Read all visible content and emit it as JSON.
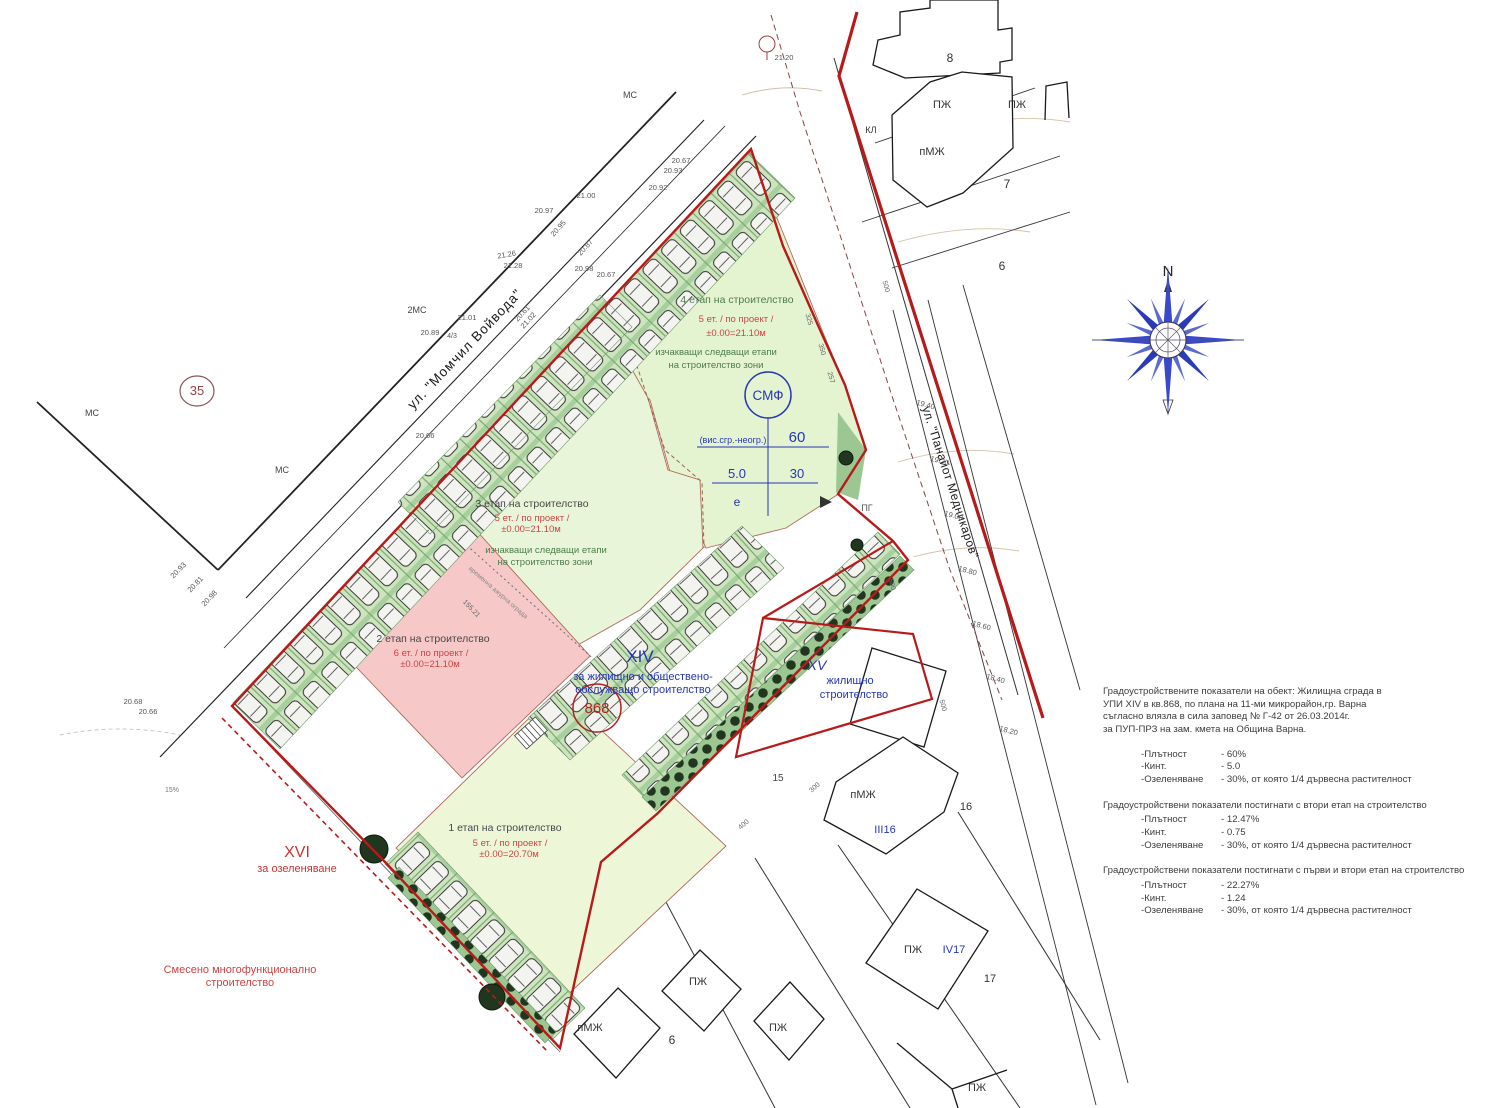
{
  "colors": {
    "regulation_red": "#b81a1a",
    "dashed_old_line": "#8b4444",
    "zone_green": "#e4f3d0",
    "zone3_green": "#e9f5d8",
    "zone1_green": "#eef6d8",
    "stage2_pink": "#f6c8c8",
    "parking_green": "#cde5bd",
    "tree_dark": "#20361f",
    "wedge_green": "#9cc793",
    "plan_blue": "#2636b8",
    "stage_red_text": "#cc4444",
    "stage_green_text": "#4c7d4c",
    "label_red": "#cc3333",
    "circle_red": "#b22222",
    "building_line": "#1a1a1a"
  },
  "compass": {
    "north_label": "N"
  },
  "stats": {
    "intro_lines": [
      "Градоустройствените показатели на обект: Жилищна сграда в",
      "УПИ XIV в кв.868, по плана на 11-ми микрорайон,гр. Варна",
      "съгласно влязла в сила заповед № Г-42 от 26.03.2014г.",
      "за ПУП-ПРЗ на зам. кмета на Община Варна."
    ],
    "groups": [
      {
        "title": "",
        "rows": [
          {
            "label": "-Плътност",
            "value": "-  60%"
          },
          {
            "label": "-Кинт.",
            "value": "-  5.0"
          },
          {
            "label": "-Озеленяване",
            "value": "-  30%, от която 1/4 дървесна растителност"
          }
        ]
      },
      {
        "title": "Градоустройствени показатели постигнати с втори етап на строителство",
        "rows": [
          {
            "label": "-Плътност",
            "value": "- 12.47%"
          },
          {
            "label": "-Кинт.",
            "value": "- 0.75"
          },
          {
            "label": "-Озеленяване",
            "value": "- 30%, от която 1/4 дървесна растителност"
          }
        ]
      },
      {
        "title": "Градоустройствени показатели постигнати с първи и втори етап на строителство",
        "rows": [
          {
            "label": "-Плътност",
            "value": "- 22.27%"
          },
          {
            "label": "-Кинт.",
            "value": "- 1.24"
          },
          {
            "label": "-Озеленяване",
            "value": "- 30%, от която 1/4 дървесна растителност"
          }
        ]
      }
    ]
  },
  "plan": {
    "default_label_color": "#555555",
    "labels": [
      {
        "id": "street-momchil-voyvoda-label",
        "text": "ул. \"Момчил Войвода\"",
        "x": 468,
        "y": 352,
        "size": 13.5,
        "color": "#1a1a1a",
        "rotate": -46.5,
        "spacing": 1
      },
      {
        "id": "street-panayot-mednikarov-label",
        "text": "ул. \"Панайот Медникаров\"",
        "x": 922,
        "y": 408,
        "size": 12,
        "color": "#1a1a1a",
        "rotate": 72,
        "anchor": "start",
        "spacing": 0.5
      },
      {
        "id": "stage4-title",
        "text": "4 етап на строителство",
        "x": 737,
        "y": 303,
        "size": 10.5,
        "color": "#4c7d4c"
      },
      {
        "id": "stage4-floors",
        "text": "5 ет. / по проект /",
        "x": 736,
        "y": 322,
        "size": 9.5,
        "color": "#cc4444"
      },
      {
        "id": "stage4-level",
        "text": "±0.00=21.10м",
        "x": 736,
        "y": 336,
        "size": 9.5,
        "color": "#cc4444"
      },
      {
        "id": "stage4-note-1",
        "text": "изчакващи следващи етапи",
        "x": 716,
        "y": 355,
        "size": 9.5,
        "color": "#4c7d4c"
      },
      {
        "id": "stage4-note-2",
        "text": "на строителство зони",
        "x": 716,
        "y": 368,
        "size": 9.5,
        "color": "#4c7d4c"
      },
      {
        "id": "stage3-title",
        "text": "3 етап на строителство",
        "x": 532,
        "y": 507,
        "size": 10.5,
        "color": "#474747"
      },
      {
        "id": "stage3-floors",
        "text": "5 ет. / по проект /",
        "x": 532,
        "y": 521,
        "size": 9.5,
        "color": "#cc4444"
      },
      {
        "id": "stage3-level",
        "text": "±0.00=21.10м",
        "x": 531,
        "y": 532,
        "size": 9.5,
        "color": "#cc4444"
      },
      {
        "id": "stage3-note-1",
        "text": "изчакващи следващи етапи",
        "x": 546,
        "y": 553,
        "size": 9.5,
        "color": "#4c7d4c"
      },
      {
        "id": "stage3-note-2",
        "text": "на строителство зони",
        "x": 545,
        "y": 565,
        "size": 9.5,
        "color": "#4c7d4c"
      },
      {
        "id": "stage2-title",
        "text": "2 етап на строителство",
        "x": 433,
        "y": 642,
        "size": 10.5,
        "color": "#474747"
      },
      {
        "id": "stage2-floors",
        "text": "6 ет. / по проект /",
        "x": 431,
        "y": 656,
        "size": 9.5,
        "color": "#cc4444"
      },
      {
        "id": "stage2-level",
        "text": "±0.00=21.10м",
        "x": 430,
        "y": 667,
        "size": 9.5,
        "color": "#cc4444"
      },
      {
        "id": "stage1-title",
        "text": "1 етап на строителство",
        "x": 505,
        "y": 831,
        "size": 10.5,
        "color": "#474747"
      },
      {
        "id": "stage1-floors",
        "text": "5 ет. / по проект /",
        "x": 510,
        "y": 846,
        "size": 9.5,
        "color": "#cc4444"
      },
      {
        "id": "stage1-level",
        "text": "±0.00=20.70м",
        "x": 509,
        "y": 857,
        "size": 9.5,
        "color": "#cc4444"
      },
      {
        "id": "parcel-xiv-label",
        "text": "XIV",
        "x": 640,
        "y": 662,
        "size": 17,
        "color": "#2636b8"
      },
      {
        "id": "parcel-xiv-use-1",
        "text": "за жилищно и обществено-",
        "x": 643,
        "y": 680,
        "size": 11,
        "color": "#2636b8"
      },
      {
        "id": "parcel-xiv-use-2",
        "text": "обслужващо строителство",
        "x": 643,
        "y": 693,
        "size": 11,
        "color": "#2636b8"
      },
      {
        "id": "quarter-868-label",
        "text": "868",
        "x": 597,
        "y": 713,
        "size": 15,
        "color": "#b22222"
      },
      {
        "id": "parcel-xv-label",
        "text": "XV",
        "x": 817,
        "y": 670,
        "size": 14,
        "color": "#2636b8",
        "italic": true
      },
      {
        "id": "parcel-xv-use-1",
        "text": "жилищно",
        "x": 850,
        "y": 684,
        "size": 11,
        "color": "#2636b8"
      },
      {
        "id": "parcel-xv-use-2",
        "text": "строителство",
        "x": 854,
        "y": 698,
        "size": 11,
        "color": "#2636b8"
      },
      {
        "id": "parcel-xvi-label",
        "text": "XVI",
        "x": 297,
        "y": 857,
        "size": 16,
        "color": "#cc3333"
      },
      {
        "id": "parcel-xvi-use",
        "text": "за озеленяване",
        "x": 297,
        "y": 872,
        "size": 11,
        "color": "#cc3333"
      },
      {
        "id": "mixed-use-note-1",
        "text": "Смесено многофункционално",
        "x": 240,
        "y": 973,
        "size": 11,
        "color": "#cc4444"
      },
      {
        "id": "mixed-use-note-2",
        "text": "строителство",
        "x": 240,
        "y": 986,
        "size": 11,
        "color": "#cc4444"
      },
      {
        "id": "smf-circle-label",
        "text": "СМФ",
        "x": 768,
        "y": 400,
        "size": 13.5,
        "color": "#2636b8"
      },
      {
        "id": "smf-height-note",
        "text": "(вис.сгр.-неогр.)",
        "x": 733,
        "y": 443,
        "size": 9,
        "color": "#2636b8"
      },
      {
        "id": "smf-value-60",
        "text": "60",
        "x": 797,
        "y": 442,
        "size": 15,
        "color": "#2636b8"
      },
      {
        "id": "smf-value-5-0",
        "text": "5.0",
        "x": 737,
        "y": 478,
        "size": 13,
        "color": "#2636b8"
      },
      {
        "id": "smf-value-30",
        "text": "30",
        "x": 797,
        "y": 478,
        "size": 13,
        "color": "#2636b8"
      },
      {
        "id": "smf-value-e",
        "text": "е",
        "x": 737,
        "y": 506,
        "size": 12,
        "color": "#2636b8"
      },
      {
        "id": "parcel-35-label",
        "text": "35",
        "x": 197,
        "y": 395,
        "size": 13,
        "color": "#994444"
      },
      {
        "id": "compass-n-label",
        "text": "N",
        "x": 1168,
        "y": 276,
        "size": 15,
        "color": "#222222"
      },
      {
        "text": "8",
        "x": 950,
        "y": 62,
        "size": 12,
        "color": "#333"
      },
      {
        "text": "ПЖ",
        "x": 942,
        "y": 108,
        "size": 11,
        "color": "#333"
      },
      {
        "text": "ПЖ",
        "x": 1017,
        "y": 108,
        "size": 11,
        "color": "#333"
      },
      {
        "text": "пМЖ",
        "x": 932,
        "y": 155,
        "size": 11,
        "color": "#333"
      },
      {
        "text": "КЛ",
        "x": 871,
        "y": 133,
        "size": 9,
        "color": "#333"
      },
      {
        "text": "7",
        "x": 1007,
        "y": 188,
        "size": 12,
        "color": "#333"
      },
      {
        "text": "6",
        "x": 1002,
        "y": 270,
        "size": 12,
        "color": "#333"
      },
      {
        "text": "15",
        "x": 778,
        "y": 781,
        "size": 10,
        "color": "#444"
      },
      {
        "text": "пМЖ",
        "x": 863,
        "y": 798,
        "size": 11,
        "color": "#333"
      },
      {
        "text": "16",
        "x": 966,
        "y": 810,
        "size": 11,
        "color": "#333"
      },
      {
        "text": "III16",
        "x": 885,
        "y": 833,
        "size": 11,
        "color": "#2636b8"
      },
      {
        "text": "ПЖ",
        "x": 913,
        "y": 953,
        "size": 11,
        "color": "#333"
      },
      {
        "text": "IV17",
        "x": 954,
        "y": 953,
        "size": 11,
        "color": "#2636b8"
      },
      {
        "text": "17",
        "x": 990,
        "y": 982,
        "size": 11,
        "color": "#333"
      },
      {
        "text": "пМЖ",
        "x": 590,
        "y": 1031,
        "size": 11,
        "color": "#333"
      },
      {
        "text": "6",
        "x": 672,
        "y": 1044,
        "size": 12,
        "color": "#333"
      },
      {
        "text": "ПЖ",
        "x": 698,
        "y": 985,
        "size": 11,
        "color": "#333"
      },
      {
        "text": "ПЖ",
        "x": 778,
        "y": 1031,
        "size": 11,
        "color": "#333"
      },
      {
        "text": "ПЖ",
        "x": 977,
        "y": 1091,
        "size": 11,
        "color": "#333"
      },
      {
        "text": "ПГ",
        "x": 867,
        "y": 511,
        "size": 9,
        "color": "#555"
      },
      {
        "text": "МС",
        "x": 92,
        "y": 416,
        "size": 9,
        "color": "#444"
      },
      {
        "text": "МС",
        "x": 282,
        "y": 473,
        "size": 9,
        "color": "#444"
      },
      {
        "text": "МС",
        "x": 630,
        "y": 98,
        "size": 9,
        "color": "#444"
      },
      {
        "text": "2МС",
        "x": 417,
        "y": 313,
        "size": 9,
        "color": "#444"
      },
      {
        "text": "4/3",
        "x": 452,
        "y": 338,
        "size": 7,
        "color": "#555"
      },
      {
        "text": "21.20",
        "x": 784,
        "y": 60,
        "size": 7.5
      },
      {
        "text": "20.67",
        "x": 681,
        "y": 163,
        "size": 7.5
      },
      {
        "text": "20.93",
        "x": 673,
        "y": 173,
        "size": 7.5
      },
      {
        "text": "20.92",
        "x": 658,
        "y": 190,
        "size": 7.5
      },
      {
        "text": "21.00",
        "x": 586,
        "y": 198,
        "size": 7.5
      },
      {
        "text": "20.97",
        "x": 544,
        "y": 213,
        "size": 7.5
      },
      {
        "text": "20.95",
        "x": 560,
        "y": 230,
        "size": 7.5,
        "rotate": -48
      },
      {
        "text": "21.26",
        "x": 507,
        "y": 257,
        "size": 7.5,
        "rotate": -10
      },
      {
        "text": "21.28",
        "x": 513,
        "y": 268,
        "size": 7.5
      },
      {
        "text": "20.87",
        "x": 587,
        "y": 249,
        "size": 7.5,
        "rotate": -48
      },
      {
        "text": "20.98",
        "x": 584,
        "y": 271,
        "size": 7.5
      },
      {
        "text": "20.67",
        "x": 606,
        "y": 277,
        "size": 7.5
      },
      {
        "text": "20.89",
        "x": 430,
        "y": 335,
        "size": 7.5
      },
      {
        "text": "21.01",
        "x": 467,
        "y": 320,
        "size": 7.5
      },
      {
        "text": "20.61",
        "x": 524,
        "y": 315,
        "size": 7.5,
        "rotate": -48
      },
      {
        "text": "21.02",
        "x": 530,
        "y": 322,
        "size": 7.5,
        "rotate": -48
      },
      {
        "text": "20.66",
        "x": 425,
        "y": 438,
        "size": 7.5
      },
      {
        "text": "20.93",
        "x": 180,
        "y": 572,
        "size": 7.5,
        "rotate": -46
      },
      {
        "text": "20.81",
        "x": 197,
        "y": 586,
        "size": 7.5,
        "rotate": -46
      },
      {
        "text": "20.98",
        "x": 211,
        "y": 600,
        "size": 7.5,
        "rotate": -46
      },
      {
        "text": "20.68",
        "x": 133,
        "y": 704,
        "size": 7.5
      },
      {
        "text": "20.66",
        "x": 148,
        "y": 714,
        "size": 7.5
      },
      {
        "text": "19.40",
        "x": 925,
        "y": 407,
        "size": 7.5,
        "rotate": 15
      },
      {
        "text": "19.20",
        "x": 939,
        "y": 463,
        "size": 7.5,
        "rotate": 15
      },
      {
        "text": "19.00",
        "x": 953,
        "y": 518,
        "size": 7.5,
        "rotate": 15
      },
      {
        "text": "18.80",
        "x": 967,
        "y": 573,
        "size": 7.5,
        "rotate": 15
      },
      {
        "text": "18.60",
        "x": 981,
        "y": 628,
        "size": 7.5,
        "rotate": 15
      },
      {
        "text": "18.40",
        "x": 995,
        "y": 681,
        "size": 7.5,
        "rotate": 15
      },
      {
        "text": "18.20",
        "x": 1008,
        "y": 733,
        "size": 7.5,
        "rotate": 15
      },
      {
        "text": "325",
        "x": 807,
        "y": 320,
        "size": 7,
        "color": "#666",
        "rotate": 74
      },
      {
        "text": "350",
        "x": 820,
        "y": 350,
        "size": 7,
        "color": "#666",
        "rotate": 74
      },
      {
        "text": "257",
        "x": 829,
        "y": 378,
        "size": 7,
        "color": "#666",
        "rotate": 74
      },
      {
        "text": "500",
        "x": 884,
        "y": 287,
        "size": 7,
        "color": "#666",
        "rotate": 74
      },
      {
        "text": "500",
        "x": 890,
        "y": 585,
        "size": 7,
        "color": "#666",
        "rotate": 74
      },
      {
        "text": "500",
        "x": 941,
        "y": 706,
        "size": 7,
        "color": "#666",
        "rotate": 74
      },
      {
        "text": "300",
        "x": 816,
        "y": 789,
        "size": 7,
        "color": "#666",
        "rotate": -42
      },
      {
        "text": "400",
        "x": 745,
        "y": 826,
        "size": 7,
        "color": "#666",
        "rotate": -42
      },
      {
        "text": "155.21",
        "x": 470,
        "y": 610,
        "size": 7,
        "color": "#666",
        "rotate": 46
      },
      {
        "text": "временна ажурна ограда",
        "x": 497,
        "y": 594,
        "size": 6.5,
        "color": "#888",
        "rotate": 41
      },
      {
        "text": "15%",
        "x": 172,
        "y": 792,
        "size": 7,
        "color": "#777"
      }
    ]
  }
}
